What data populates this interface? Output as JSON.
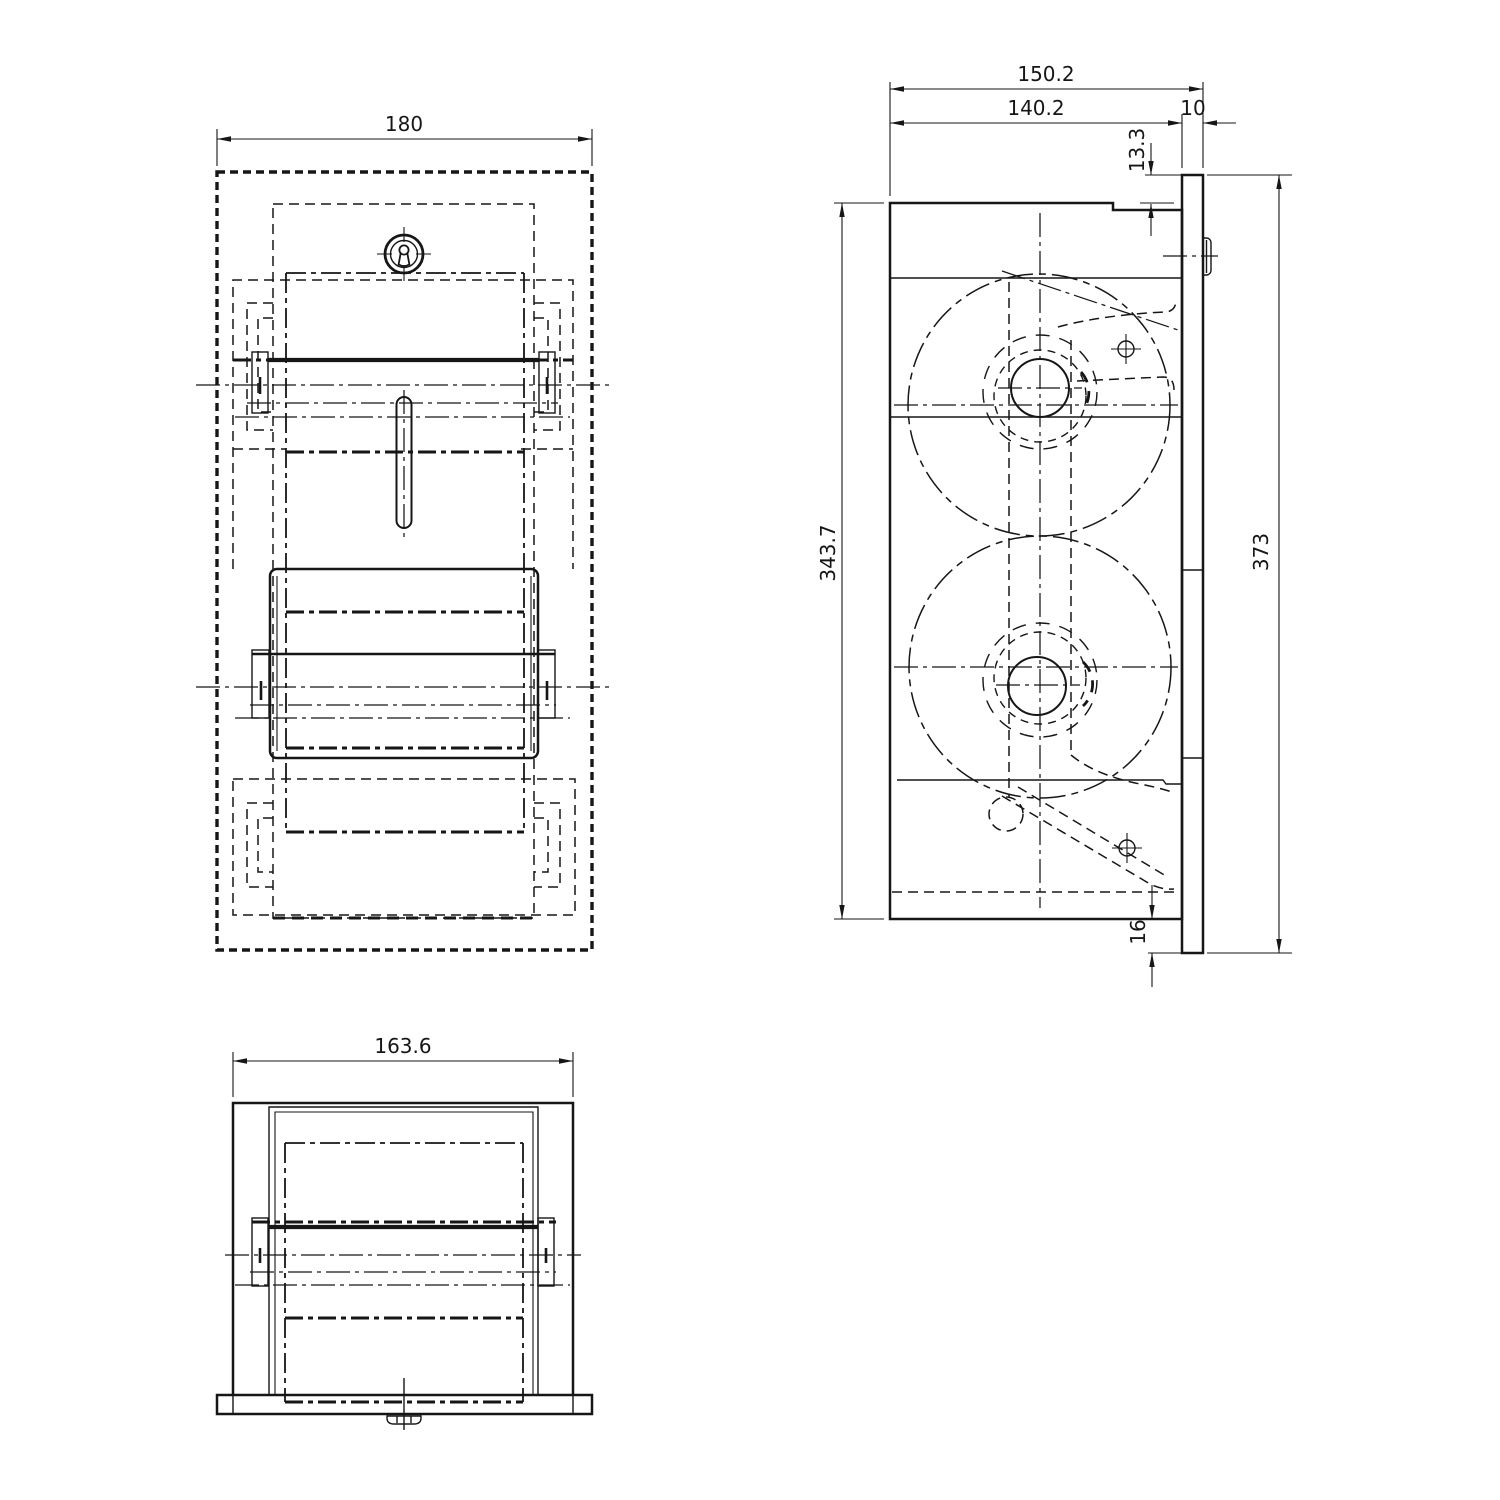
{
  "meta": {
    "type": "technical-drawing",
    "subject": "recessed dual toilet-roll dispenser, three orthographic views",
    "background_color": "#ffffff",
    "line_color": "#161616"
  },
  "dimensions": {
    "front_width": "180",
    "bottom_width": "163.6",
    "depth_total": "150.2",
    "depth_body": "140.2",
    "flange_thickness": "10",
    "top_offset": "13.3",
    "body_height": "343.7",
    "overall_height": "373",
    "bottom_offset": "16"
  }
}
